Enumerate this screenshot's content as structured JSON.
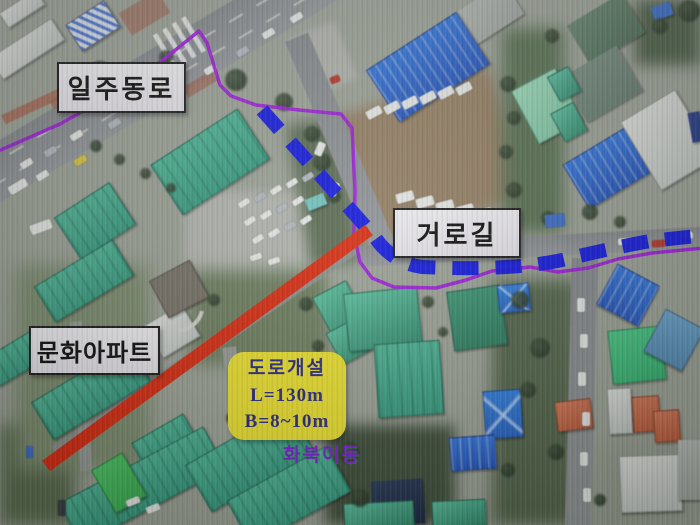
{
  "labels": {
    "road_main": "일주동로",
    "road_new": "거로길",
    "apartment": "문화아파트",
    "district": "화북이동"
  },
  "info_box": {
    "line1": "도로개설",
    "line2": "L=130m",
    "line3": "B=8~10m"
  },
  "colors": {
    "red": "#de2c10",
    "blue": "#1016e6",
    "purple": "#a21ae0",
    "yellow": "#f2e72f",
    "labelbg": "#ece9ef",
    "navy": "#2b2a85",
    "place": "#7d1fd6"
  }
}
